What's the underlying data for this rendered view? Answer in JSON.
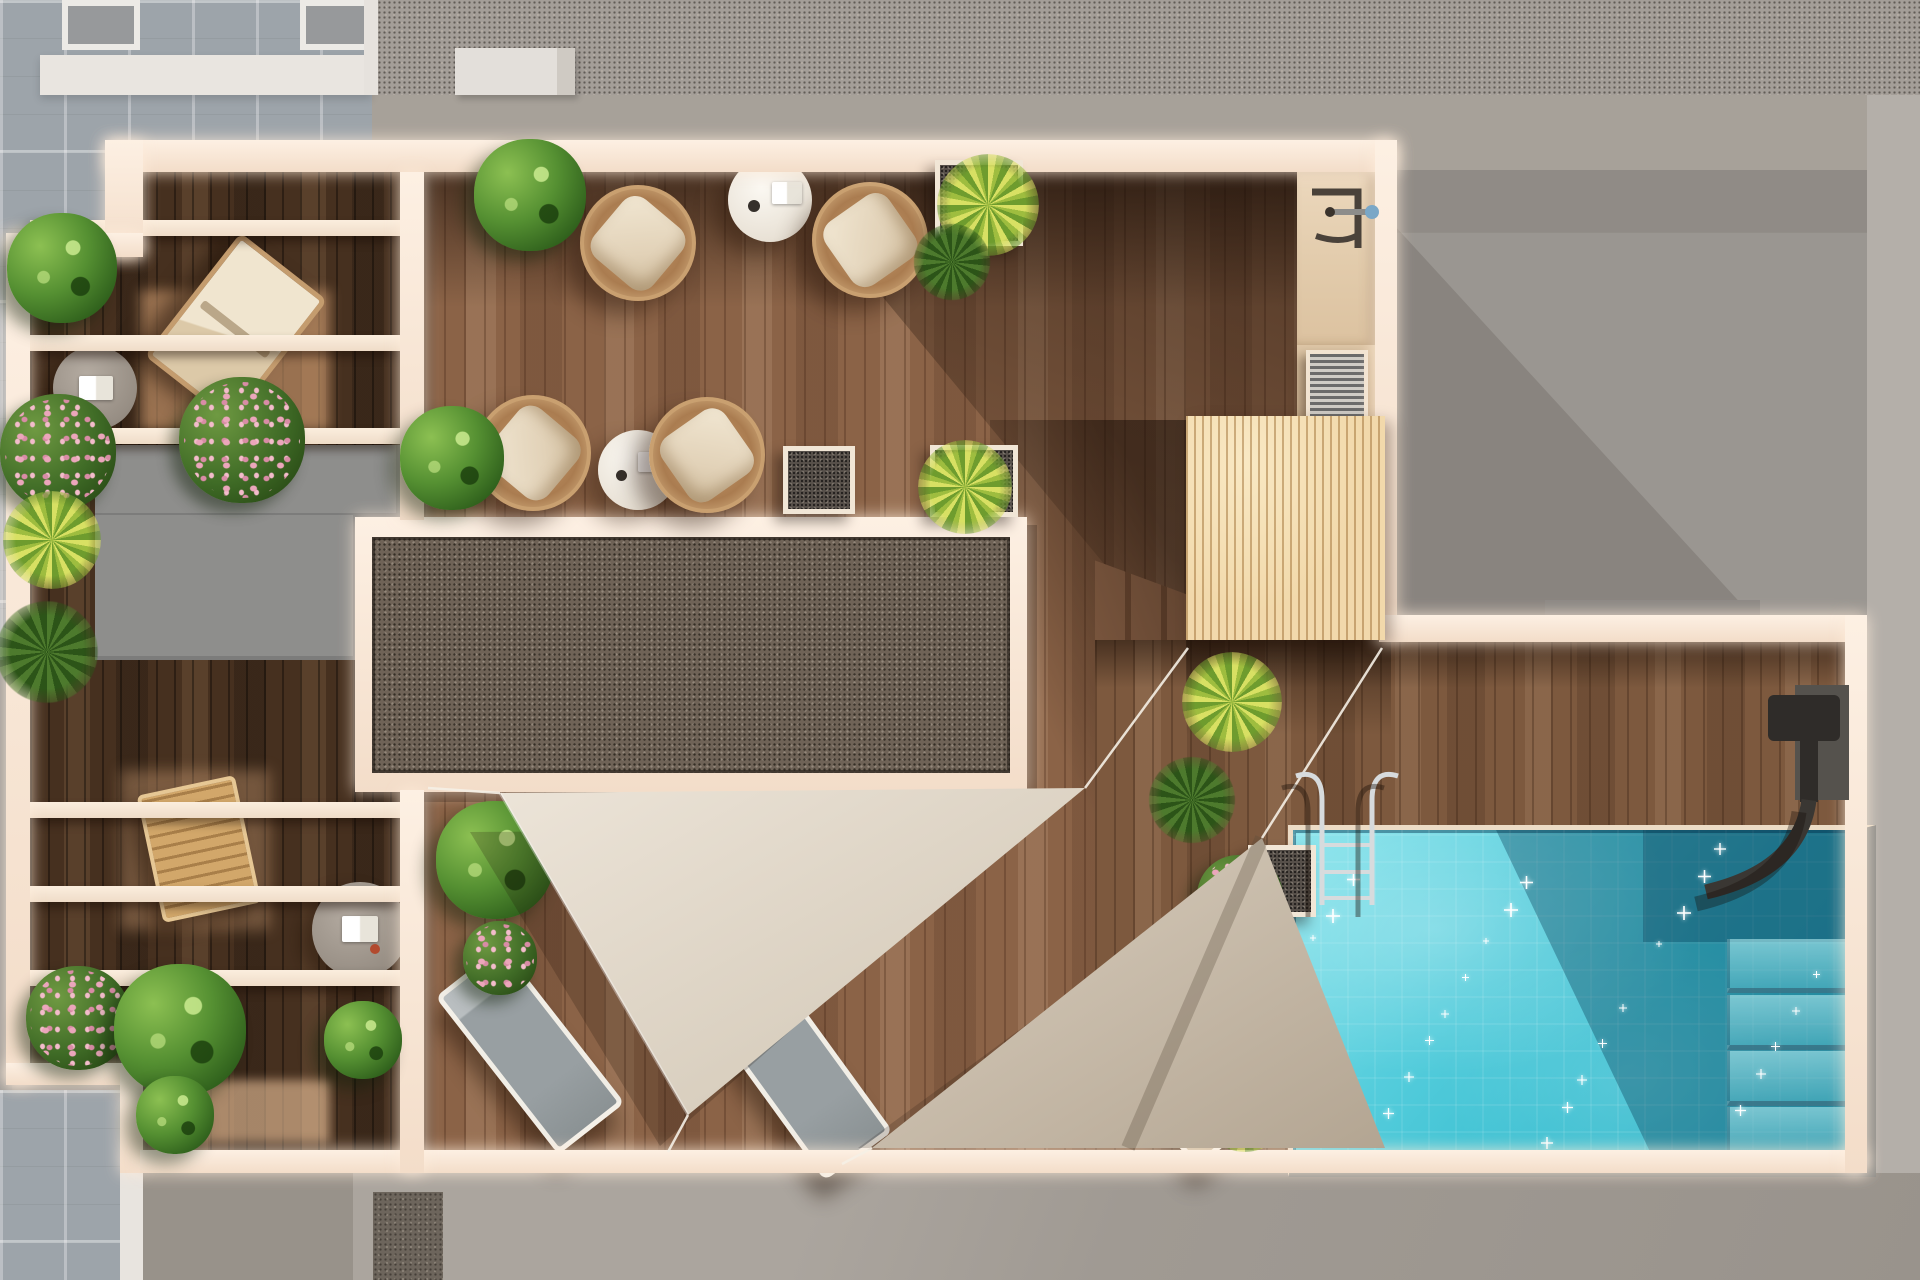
{
  "scene": {
    "kind": "architectural top-view 3D render",
    "subject": "Rooftop terrace floor plan with lounge areas, pergolas, shade sails and swimming pool",
    "visible_text": "",
    "time_of_day": "sunny daylight with hard shadows falling toward lower-left"
  },
  "palette": {
    "bg-base": "#a49e98",
    "conc-dark": "#8b8885",
    "tile": "#9da4aa",
    "wall": "#fdf0e3",
    "wall2": "#f3ddc9",
    "wood-dark": "#46301f",
    "wood-mid": "#8b6347",
    "wood-pool": "#7d593e",
    "gravel": "#6f6357",
    "slat": "#f2d9ab",
    "block": "#8e8e8c",
    "slab": "#9a9691",
    "water-light": "#8ae4ec",
    "water-deep": "#2fb2c6",
    "sail-light": "#e3dacc",
    "sail-dark": "#cdbfae",
    "cushion": "#ecdfc9",
    "frame-tan": "#c9a070",
    "plant-green": "#4e7d2b",
    "plant-yellowgreen": "#9ebd3f",
    "flower-pink": "#eba6bb",
    "chrome": "#d7dbdd",
    "fixture-dark": "#33302c"
  },
  "inventory": {
    "areas": [
      {
        "name": "pergola-wing",
        "description": "left balcony strip with white pergola beams over dark wood"
      },
      {
        "name": "main-deck",
        "description": "central timber terrace with two seating groups"
      },
      {
        "name": "gravel-panel",
        "description": "large framed gravel / skylight rectangle"
      },
      {
        "name": "shade-sail-area",
        "description": "two triangular shade sails over sun loungers"
      },
      {
        "name": "pool-terrace",
        "description": "lower deck with swimming pool, steps and ladder"
      },
      {
        "name": "timber-canopy",
        "description": "light slatted timber roof box beside stairs"
      },
      {
        "name": "neighbor-roof-slab",
        "description": "plain concrete roof, not part of terrace"
      }
    ],
    "objects": {
      "wicker_chairs": 4,
      "white_round_tables": 2,
      "taupe_side_tables": 2,
      "upholstered_deck_chair": 1,
      "wooden_deck_chair": 1,
      "sun_loungers": 3,
      "shade_sails": 2,
      "pool_steps": 4,
      "pool_ladder": 1,
      "outdoor_showers": 2,
      "stair_treads": 6,
      "pergola_beams_upper": 3,
      "pergola_beams_lower": 3,
      "planter_boxes": 4,
      "roof_vents": 2,
      "pool_sparkles": 26
    }
  }
}
